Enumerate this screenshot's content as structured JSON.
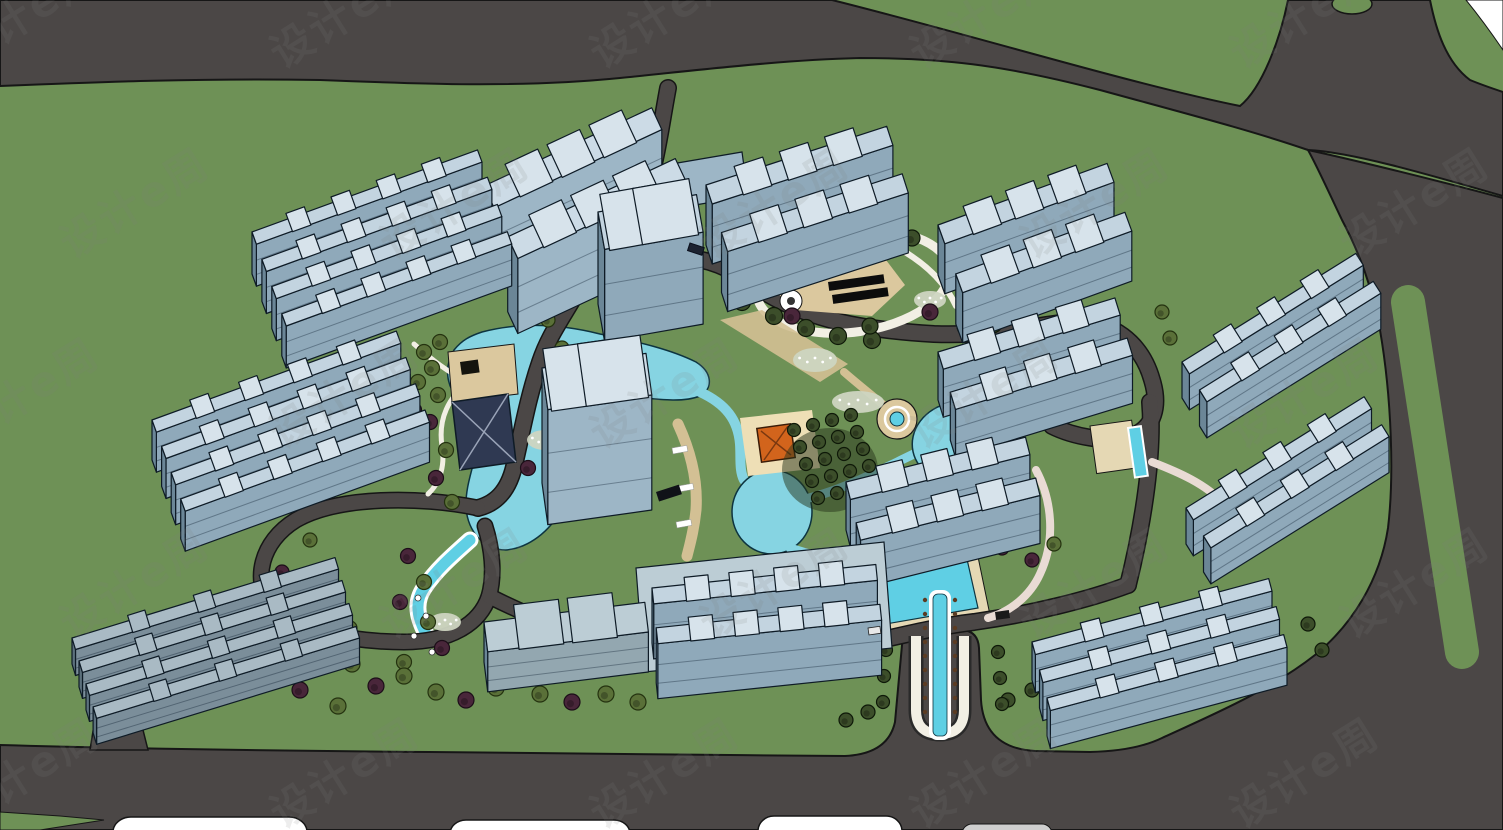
{
  "watermark": {
    "text": "设计e周"
  },
  "palette": {
    "grass": "#6e9156",
    "road": "#4b4746",
    "road_outline": "#161616",
    "water": "#86d4e2",
    "water_bright": "#5fcfe4",
    "water_outline": "#0d3440",
    "building_roof": "#c3d4e0",
    "building_face": "#8fa9ba",
    "building_side": "#6b8697",
    "building_cap": "#d7e3eb",
    "building_outline": "#0e1b26",
    "building_roof_light": "#ccdbe6",
    "building_face_light": "#9db6c6",
    "building_roof_dark": "#a9bac4",
    "building_face_dark": "#7b8e9a",
    "building_side_dark": "#5d717d",
    "podium_roof": "#bccdd5",
    "podium_face": "#93a7b0",
    "path_white": "#f2efe4",
    "path_tan": "#d3c094",
    "path_pink": "#e9dbd4",
    "plaza_tan": "#dbc89e",
    "deck_beige": "#e5d8b4",
    "tree_dark": "#3c4e2a",
    "tree_olive": "#5a7038",
    "tree_purple": "#49263a",
    "shrub_light": "#ced5c1",
    "pavilion_orange": "#d2641c",
    "canopy_navy": "#2f3952",
    "pergola_black": "#0c0c0c",
    "white": "#ffffff",
    "vehicle_dark": "#1c2230",
    "vehicle_black": "#101218",
    "vehicle_white": "#e8e8e8",
    "planter_brown": "#5b3b22"
  }
}
